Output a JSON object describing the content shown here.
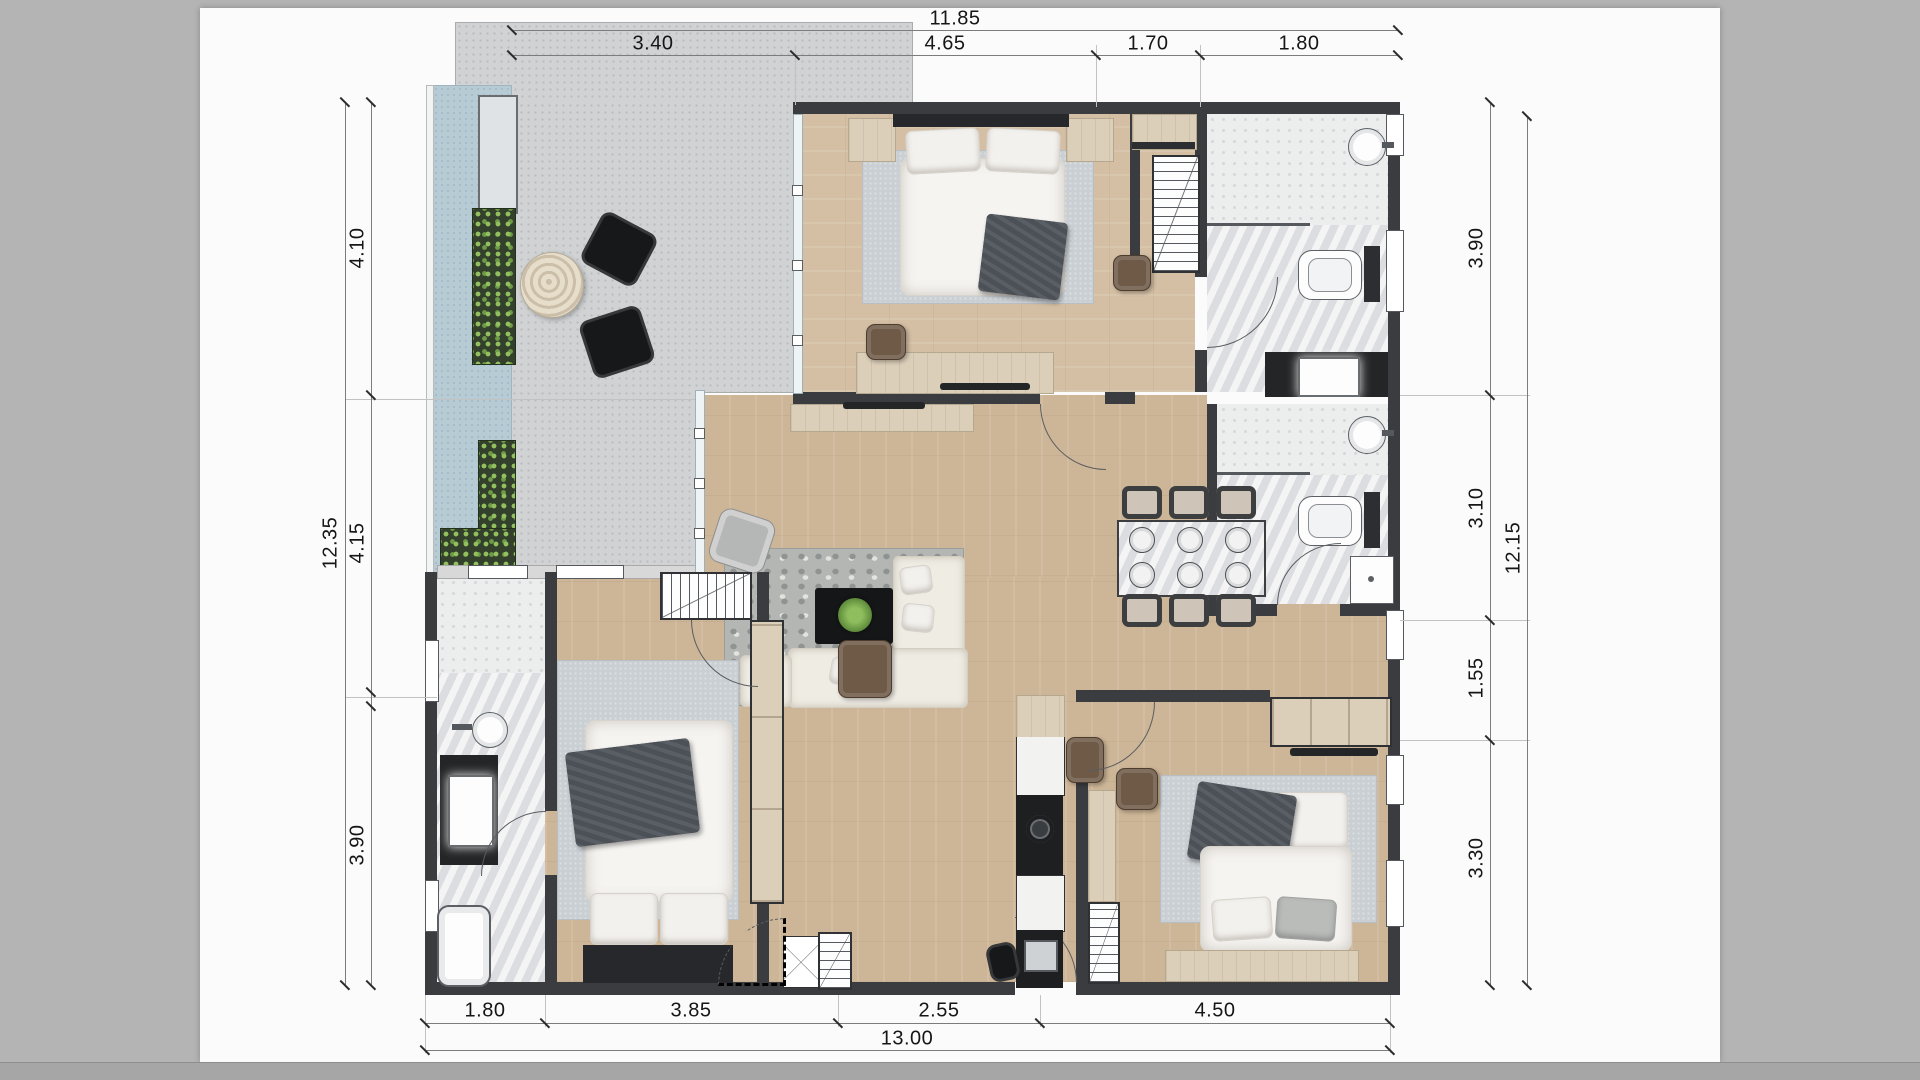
{
  "dimensions": {
    "top": {
      "overall": "11.85",
      "segments": [
        "3.40",
        "4.65",
        "1.70",
        "1.80"
      ]
    },
    "bottom": {
      "overall": "13.00",
      "segments": [
        "1.80",
        "3.85",
        "2.55",
        "4.50"
      ]
    },
    "left": {
      "overall": "12.35",
      "segments": [
        "4.10",
        "4.15",
        "3.90"
      ]
    },
    "right": {
      "overall": "12.15",
      "segments": [
        "3.90",
        "3.10",
        "1.55",
        "3.30"
      ]
    }
  },
  "colors": {
    "backdrop": "#b4b4b4",
    "page": "#fbfbfb",
    "wall": "#3a3c40",
    "wood_floor": "#cdb597",
    "terrace": "#d0d2d4",
    "pool": "#b7cbd4",
    "planter_foliage": "#92c05f",
    "marble": "#e6e7e9",
    "rug": "#c9cfd3",
    "dark_furniture": "#232527"
  }
}
